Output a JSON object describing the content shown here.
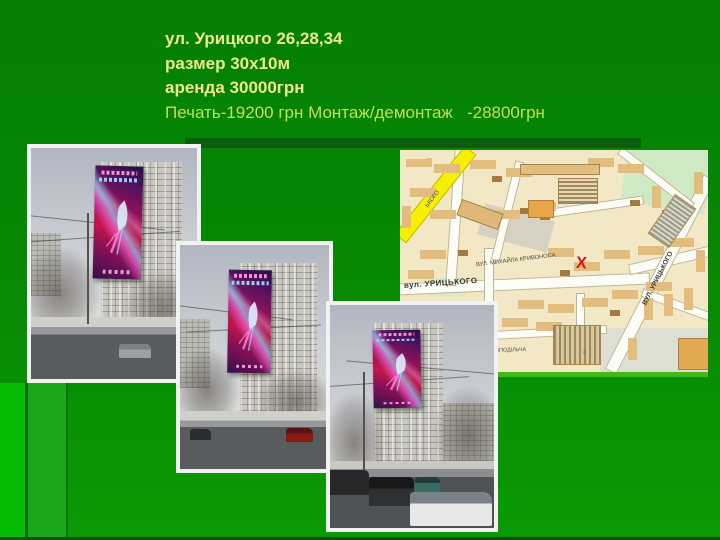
{
  "slide": {
    "lines": {
      "address": "ул. Урицкого 26,28,34",
      "size": "размер 30х10м",
      "rent": "аренда 30000грн",
      "print": "Печать-19200 грн Монтаж/демонтаж   -28800грн"
    },
    "colors": {
      "background_green": "#078a04",
      "title_bold_text": "#ede98b",
      "title_light_text": "#c9dc4f",
      "banner_magenta": "#c3164b",
      "banner_purple": "#35104e"
    }
  },
  "map": {
    "marker": {
      "glyph": "X",
      "color": "#e01111"
    },
    "labels": [
      {
        "text": "вул. УРИЦЬКОГО"
      },
      {
        "text": "ВУЛ. МИХАЙЛА КРИВОНОСА"
      },
      {
        "text": "ВУЛ. УРИЦЬКОГО"
      },
      {
        "text": "РОЗПОДІЛЬЧА"
      },
      {
        "text": "ЬКОГО"
      },
      {
        "text": "2"
      }
    ],
    "colors": {
      "base": "#f2e8c6",
      "building": "#e2bd7d",
      "highlighted_road": "#f6f000",
      "park": "#cfe9c4"
    }
  }
}
